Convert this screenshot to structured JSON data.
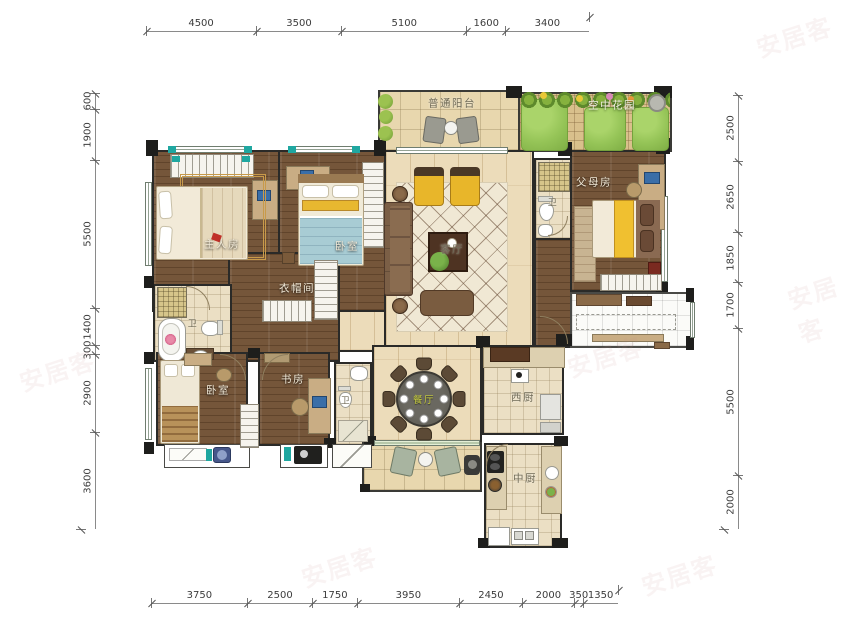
{
  "watermark": {
    "text": "安居客"
  },
  "dimensions": {
    "top": [
      "4500",
      "3500",
      "5100",
      "1600",
      "3400"
    ],
    "bottom": [
      "3750",
      "2500",
      "1750",
      "3950",
      "2450",
      "2000",
      "350",
      "1350"
    ],
    "left": [
      "600",
      "1900",
      "5500",
      "1400",
      "300",
      "2900",
      "3600"
    ],
    "right": [
      "2500",
      "2650",
      "1850",
      "1700",
      "5500",
      "2000"
    ]
  },
  "rooms": {
    "balcony": {
      "label": "普通阳台"
    },
    "sky_garden": {
      "label": "空中花园"
    },
    "master_bedroom": {
      "label": "主人房"
    },
    "bedroom_2": {
      "label": "卧室"
    },
    "cloakroom": {
      "label": "衣帽间"
    },
    "living_room": {
      "label": "客厅"
    },
    "parents_room": {
      "label": "父母房"
    },
    "master_bath": {
      "label": "卫"
    },
    "bath_2": {
      "label": "卫"
    },
    "bath_3": {
      "label": "卫"
    },
    "bedroom_3": {
      "label": "卧室"
    },
    "study": {
      "label": "书房"
    },
    "dining_room": {
      "label": "餐厅"
    },
    "west_kitchen": {
      "label": "西厨"
    },
    "chinese_kitchen": {
      "label": "中厨"
    }
  },
  "colors": {
    "wall": "#262626",
    "wood_dark": "#75563A",
    "wood_light": "#ECDCBA",
    "tile": "#EBDFC4",
    "grass": "#95C457",
    "rug_red": "#963826",
    "accent_yellow": "#E8B62A",
    "blanket_blue": "#A8CCD4",
    "window_teal": "#1FA7A0"
  }
}
